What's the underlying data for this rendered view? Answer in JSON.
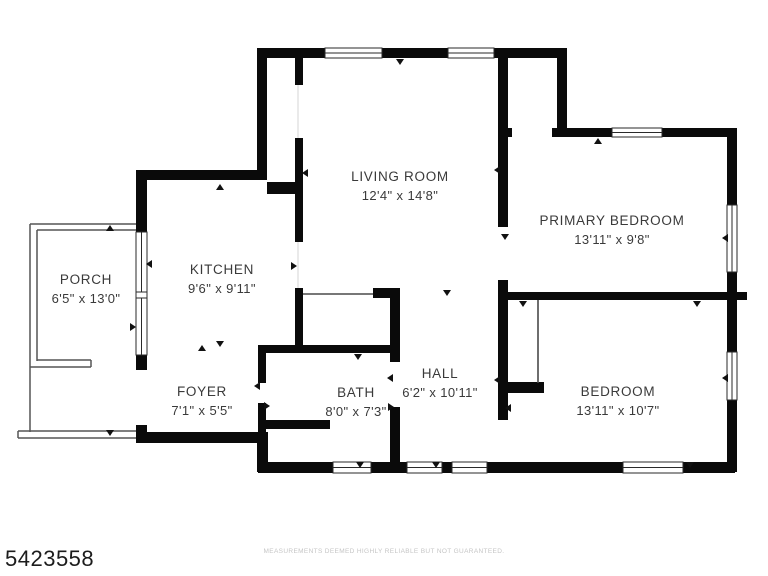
{
  "floorplan": {
    "rooms": {
      "porch": {
        "name": "PORCH",
        "dims": "6'5\" x 13'0\""
      },
      "kitchen": {
        "name": "KITCHEN",
        "dims": "9'6\" x 9'11\""
      },
      "living_room": {
        "name": "LIVING ROOM",
        "dims": "12'4\" x 14'8\""
      },
      "primary_bedroom": {
        "name": "PRIMARY BEDROOM",
        "dims": "13'11\" x 9'8\""
      },
      "foyer": {
        "name": "FOYER",
        "dims": "7'1\" x 5'5\""
      },
      "bath": {
        "name": "BATH",
        "dims": "8'0\" x 7'3\""
      },
      "hall": {
        "name": "HALL",
        "dims": "6'2\" x 10'11\""
      },
      "bedroom": {
        "name": "BEDROOM",
        "dims": "13'11\" x 10'7\""
      }
    },
    "footer": {
      "listing_id": "5423558",
      "disclaimer": "MEASUREMENTS DEEMED HIGHLY RELIABLE BUT NOT GUARANTEED."
    },
    "colors": {
      "wall": "#0a0a0a",
      "background": "#ffffff",
      "label_text": "#3a3a3a",
      "listing_id_text": "#1c1c1c",
      "disclaimer_text": "#c5c5c5"
    }
  }
}
